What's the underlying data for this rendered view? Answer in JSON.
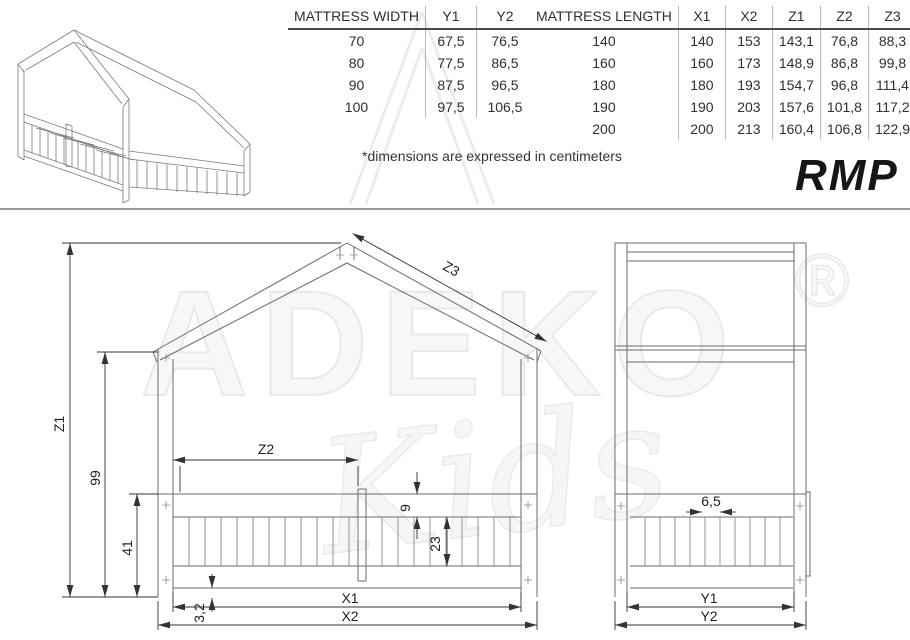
{
  "header": {
    "note": "*dimensions are expressed in centimeters",
    "model": "RMP"
  },
  "tables": {
    "width": {
      "headers": [
        "MATTRESS WIDTH",
        "Y1",
        "Y2"
      ],
      "rows": [
        [
          "70",
          "67,5",
          "76,5"
        ],
        [
          "80",
          "77,5",
          "86,5"
        ],
        [
          "90",
          "87,5",
          "96,5"
        ],
        [
          "100",
          "97,5",
          "106,5"
        ]
      ]
    },
    "length": {
      "headers": [
        "MATTRESS LENGTH",
        "X1",
        "X2",
        "Z1",
        "Z2",
        "Z3"
      ],
      "rows": [
        [
          "140",
          "140",
          "153",
          "143,1",
          "76,8",
          "88,3"
        ],
        [
          "160",
          "160",
          "173",
          "148,9",
          "86,8",
          "99,8"
        ],
        [
          "180",
          "180",
          "193",
          "154,7",
          "96,8",
          "111,4"
        ],
        [
          "190",
          "190",
          "203",
          "157,6",
          "101,8",
          "117,2"
        ],
        [
          "200",
          "200",
          "213",
          "160,4",
          "106,8",
          "122,9"
        ]
      ]
    }
  },
  "front_view": {
    "labels": {
      "total_height": "Z1",
      "eaves_height": "99",
      "rail_height": "41",
      "opening_width": "Z2",
      "roof_slope": "Z3",
      "rail_board": "9",
      "slat_board": "23",
      "bottom_gap": "3,2",
      "inner_length": "X1",
      "outer_length": "X2"
    }
  },
  "side_view": {
    "labels": {
      "slat_pitch": "6,5",
      "inner_width": "Y1",
      "outer_width": "Y2"
    }
  },
  "watermark": {
    "brand": "ADEKO",
    "script": "Kids",
    "registered": "®"
  }
}
